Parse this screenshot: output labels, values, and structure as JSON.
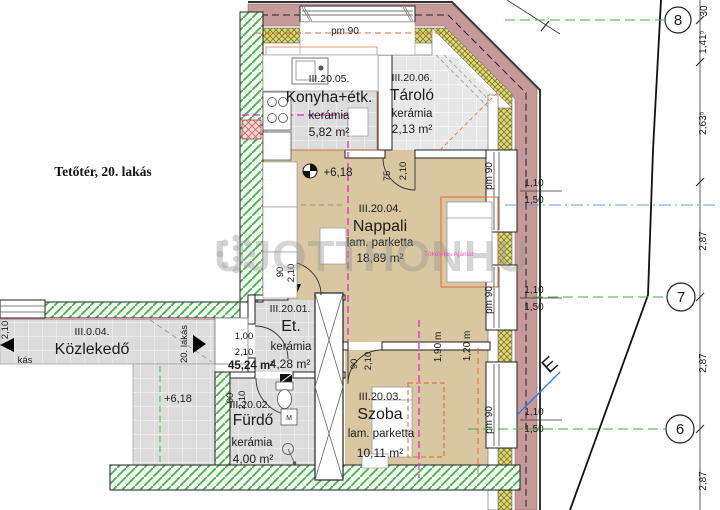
{
  "title": "Tetőtér, 20. lakás",
  "watermark": {
    "text": "UJOTTHON",
    "suffix": "HU",
    "tagline": "Tökéletes Ajánlat"
  },
  "total_area": "45,24 m²",
  "elevation": "+6,18",
  "rooms": {
    "konyha": {
      "id": "III.20.05.",
      "name": "Konyha+étk.",
      "finish": "kerámia",
      "area": "5,82 m²"
    },
    "tarolo": {
      "id": "III.20.06.",
      "name": "Tároló",
      "finish": "kerámia",
      "area": "2,13 m²"
    },
    "nappali": {
      "id": "III.20.04.",
      "name": "Nappali",
      "finish": "lam. parketta",
      "area": "18,89 m²"
    },
    "eloter": {
      "id": "III.20.01.",
      "name": "Et.",
      "finish": "kerámia",
      "area": "4,28 m²"
    },
    "furdo": {
      "id": "III.20.02.",
      "name": "Fürdő",
      "finish": "kerámia",
      "area": "4,00 m²"
    },
    "szoba": {
      "id": "III.20.03.",
      "name": "Szoba",
      "finish": "lam. parketta",
      "area": "10,11 m²"
    },
    "kozlekedo": {
      "id": "III.0.04.",
      "name": "Közlekedő"
    }
  },
  "grid": {
    "g8": "8",
    "g7": "7",
    "g6": "6"
  },
  "chain": [
    "30",
    "1,41⁵",
    "2,63⁵",
    "2,87",
    "2,87",
    "2,87"
  ],
  "dims": {
    "pm90": "pm 90",
    "w110": "1,10",
    "w150": "1,50",
    "d90": "90",
    "d210": "2,10",
    "d75": "75",
    "d100": "1,00",
    "slope190": "1,90 m",
    "slope120": "1,20 m"
  },
  "labels": {
    "entry": "20. lakás",
    "left_truncated": "kás",
    "north": "E",
    "washer": "M"
  },
  "colors": {
    "eave": "#c69a9a",
    "insulation": "#ded87e",
    "wall_hatch": "#46b24a",
    "floor_tile": "#dcdcdc",
    "floor_wood": "#d8c7a0",
    "line_190": "#dd22cc",
    "line_120": "#e06838",
    "total_red": "#d93025",
    "grid_green": "#3db23d",
    "ref_blue": "#6699ee"
  }
}
